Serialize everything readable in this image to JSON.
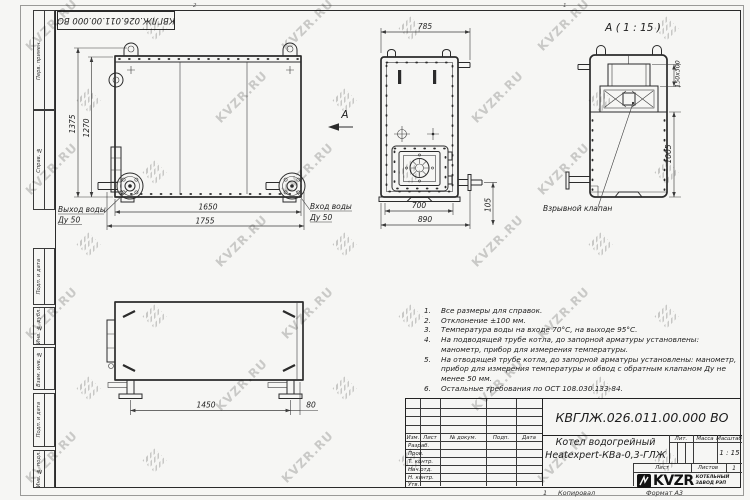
{
  "doc": {
    "number": "КВГЛЖ.026.011.00.000 ВО",
    "title_line1": "Котел водогрейный",
    "title_line2": "Heatexpert-КВа-0,3-ГЛЖ",
    "copied_num": "1",
    "copied_label": "Копировал",
    "format_label": "Формат А3",
    "company": {
      "logo_text": "KVZR",
      "name_line1": "КОТЕЛЬНЫЙ",
      "name_line2": "ЗАВОД РЭП"
    }
  },
  "title_block": {
    "headers": {
      "izm": "Изм.",
      "list": "Лист",
      "n_dokum": "№ докум.",
      "podp": "Подп.",
      "data": "Дата"
    },
    "rows": [
      "Разраб.",
      "Пров.",
      "Т. контр.",
      "Нач.отд.",
      "Н. контр.",
      "Утв."
    ],
    "lit_label": "Лит.",
    "massa_label": "Масса",
    "masshtab_label": "Масштаб",
    "scale_value": "1 : 15",
    "list_label": "Лист",
    "listov_label": "Листов",
    "listov_value": "1"
  },
  "frame": {
    "stamp_number": "КВГЛЖ.026.011.00.000 ВО",
    "side_columns": [
      "Перв. примен.",
      "Справ. №",
      "Подп. и дата",
      "Инв. № дубл.",
      "Взам. инв. №",
      "Подп. и дата",
      "Инв. № подл."
    ],
    "zone_labels": [
      "2",
      "1"
    ]
  },
  "views": {
    "front": {
      "dim_height_total": "1375",
      "dim_height_body": "1270",
      "dim_width_inner": "1650",
      "dim_width_total": "1755",
      "label_outlet_1": "Выход воды",
      "label_outlet_2": "Ду 50",
      "label_inlet_1": "Вход воды",
      "label_inlet_2": "Ду 50",
      "view_arrow": "А"
    },
    "side": {
      "dim_top": "785",
      "dim_bottom_inner": "700",
      "dim_bottom_total": "890",
      "dim_pipe_height": "105"
    },
    "detail": {
      "title": "А ( 1 : 15 )",
      "dim_valve": "150x300",
      "dim_height": "1005",
      "label_valve": "Взрывной клапан"
    },
    "top": {
      "dim_span": "1450",
      "dim_offset": "80"
    }
  },
  "notes": {
    "numbers": [
      "1.",
      "2.",
      "3.",
      "4.",
      "5.",
      "6."
    ],
    "items": [
      "Все размеры для справок.",
      "Отклонение ±100 мм.",
      "Температура воды на входе 70°С, на выходе 95°С.",
      "На подводящей трубе котла, до запорной арматуры установлены: манометр, прибор для измерения температуры.",
      "На отводящей трубе котла, до запорной арматуры установлены: манометр, прибор для измерения температуры и обвод с обратным клапаном Ду не менее 50 мм.",
      "Остальные требования по ОСТ 108.030.133-84."
    ]
  },
  "watermark": {
    "text": "KVZR.RU"
  },
  "colors": {
    "line": "#2b2b2b",
    "paper": "#f6f6f4",
    "watermark": "#c2c2c0"
  }
}
